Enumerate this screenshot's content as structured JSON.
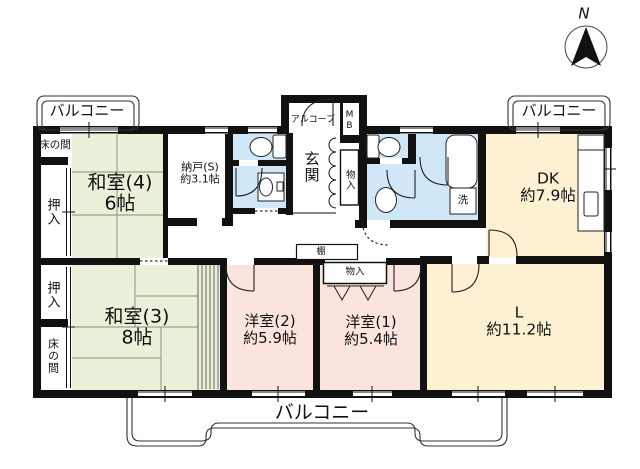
{
  "compass": {
    "north_label": "N"
  },
  "balcony": {
    "top_left": "バルコニー",
    "top_right": "バルコニー",
    "bottom": "バルコニー"
  },
  "rooms": {
    "washitsu4": {
      "name": "和室(4)",
      "area": "6帖"
    },
    "nando": {
      "name": "納戸(S)",
      "area": "約3.1帖"
    },
    "washitsu3": {
      "name": "和室(3)",
      "area": "8帖"
    },
    "yoshitsu2": {
      "name": "洋室(2)",
      "area": "約5.9帖"
    },
    "yoshitsu1": {
      "name": "洋室(1)",
      "area": "約5.4帖"
    },
    "dk": {
      "name": "DK",
      "area": "約7.9帖"
    },
    "living": {
      "name": "L",
      "area": "約11.2帖"
    },
    "genkan": {
      "name": "玄関"
    }
  },
  "features": {
    "alcove": "アルコーブ",
    "meter_box": "MB",
    "tokonoma_top": "床の間",
    "tokonoma_bottom": "床の間",
    "oshiire_top": "押入",
    "oshiire_bottom": "押入",
    "storage_hall": "物入",
    "storage_bedroom": "物入",
    "shelf": "棚",
    "washer": "洗"
  },
  "colors": {
    "tatami": "#e9f1da",
    "western": "#fbe4dd",
    "ldk": "#fdf0d3",
    "wet": "#cfe7f6",
    "wall": "#111111"
  }
}
